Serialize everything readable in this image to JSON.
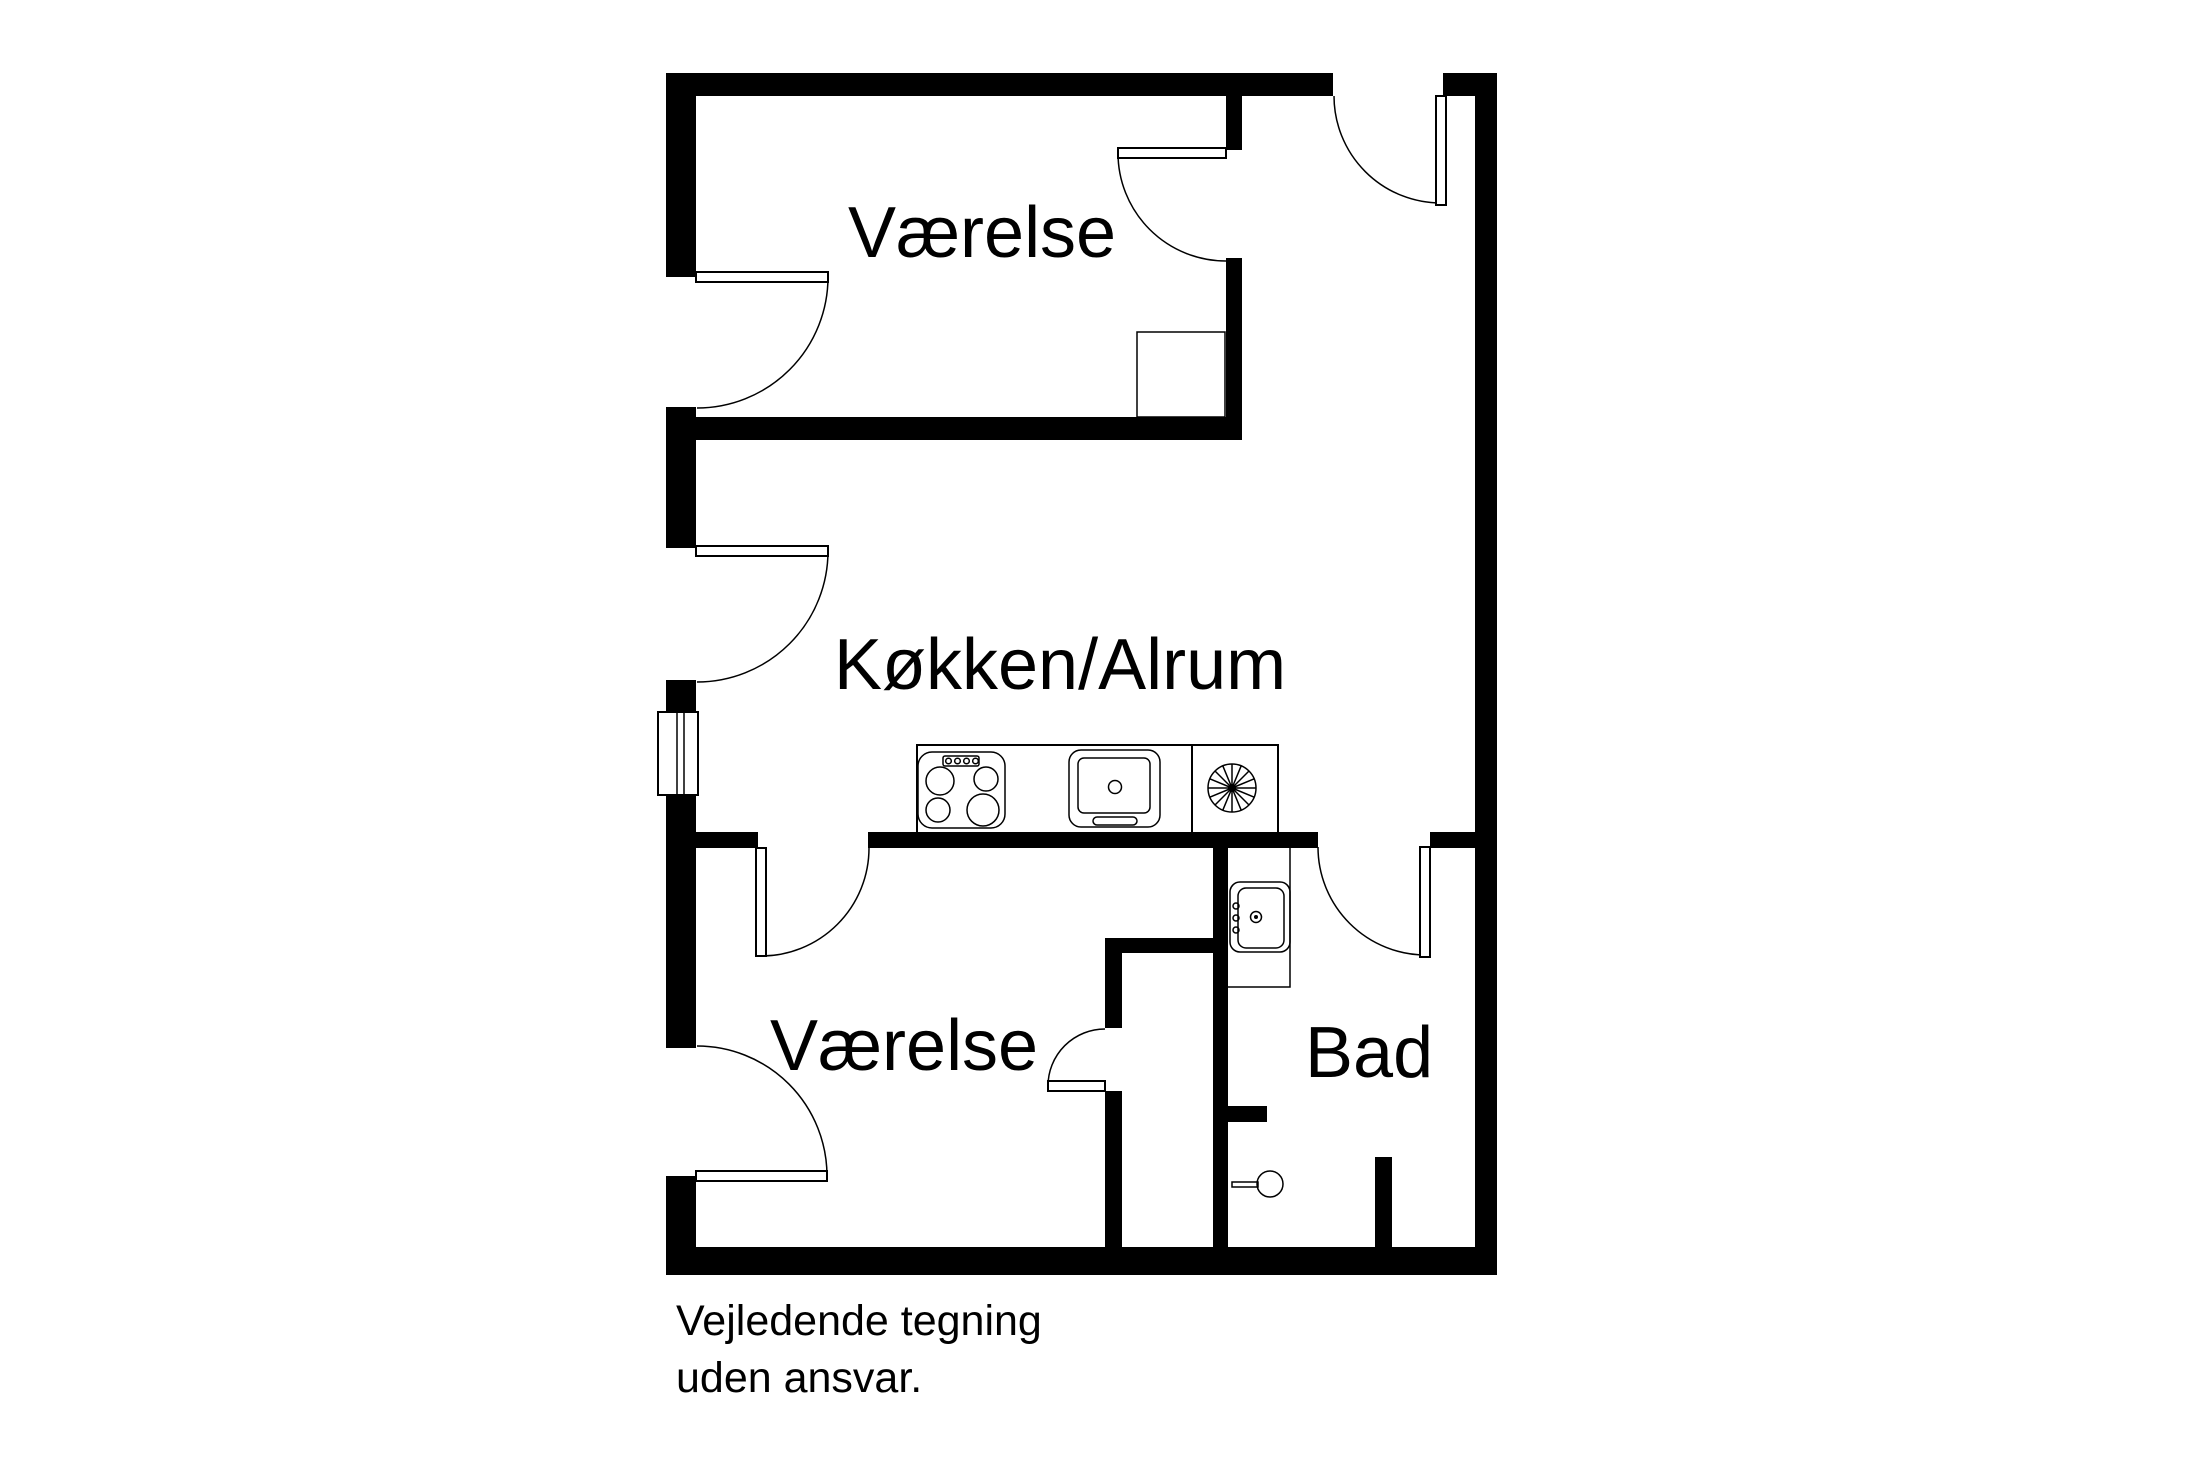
{
  "plan": {
    "rooms": {
      "bedroom_top": {
        "label": "Værelse"
      },
      "kitchen": {
        "label": "Køkken/Alrum"
      },
      "bedroom_bottom": {
        "label": "Værelse"
      },
      "bathroom": {
        "label": "Bad"
      }
    },
    "footer": {
      "line1": "Vejledende tegning",
      "line2": "uden ansvar."
    },
    "colors": {
      "wall": "#000000",
      "line": "#000000",
      "background": "#ffffff"
    },
    "symbols": {
      "stove": "stove-hob-4-burners",
      "kitchen_sink": "kitchen-sink",
      "extractor_fan": "extractor-fan",
      "bathroom_sink": "washbasin",
      "shower_fitting": "shower-valve-handle",
      "window": "window",
      "doors": "hinged-door-with-swing-arc"
    }
  }
}
